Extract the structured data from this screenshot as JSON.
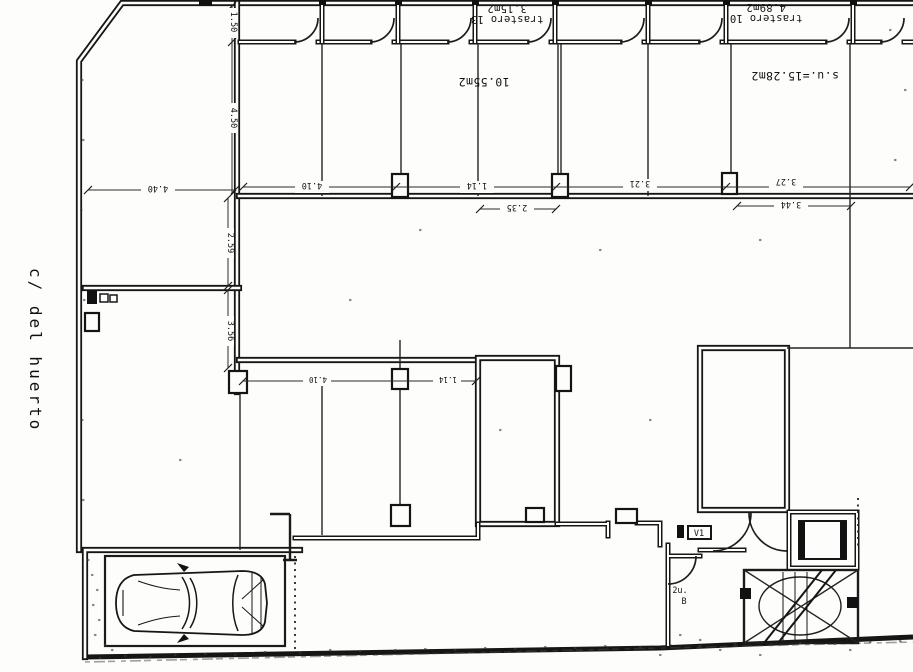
{
  "plan": {
    "street_label": "c/ del huerto",
    "rooms": {
      "trastero13_name": "trastero 13",
      "trastero13_area": "3.15m2",
      "trastero10_name": "trastero 10",
      "trastero10_area": "4.89m2",
      "open_area": "10.55m2",
      "useful_area": "s.u.=15.28m2"
    },
    "annotations": {
      "panel": "V1",
      "door_label_1": "2u.",
      "door_label_2": "B"
    },
    "dims": {
      "left_horiz": "4.40",
      "main_1": "4.10",
      "main_2": "1.14",
      "main_3": "3.21",
      "main_4": "3.27",
      "sub_1": "2.35",
      "sub_2": "3.44",
      "vert_1": "1.50",
      "vert_2": "4.50",
      "vert_3": "2.59",
      "vert_4": "3.56",
      "mid_1": "4.10",
      "mid_2": "1.14"
    }
  },
  "colors": {
    "paper": "#fdfdfc",
    "ink": "#161616"
  }
}
